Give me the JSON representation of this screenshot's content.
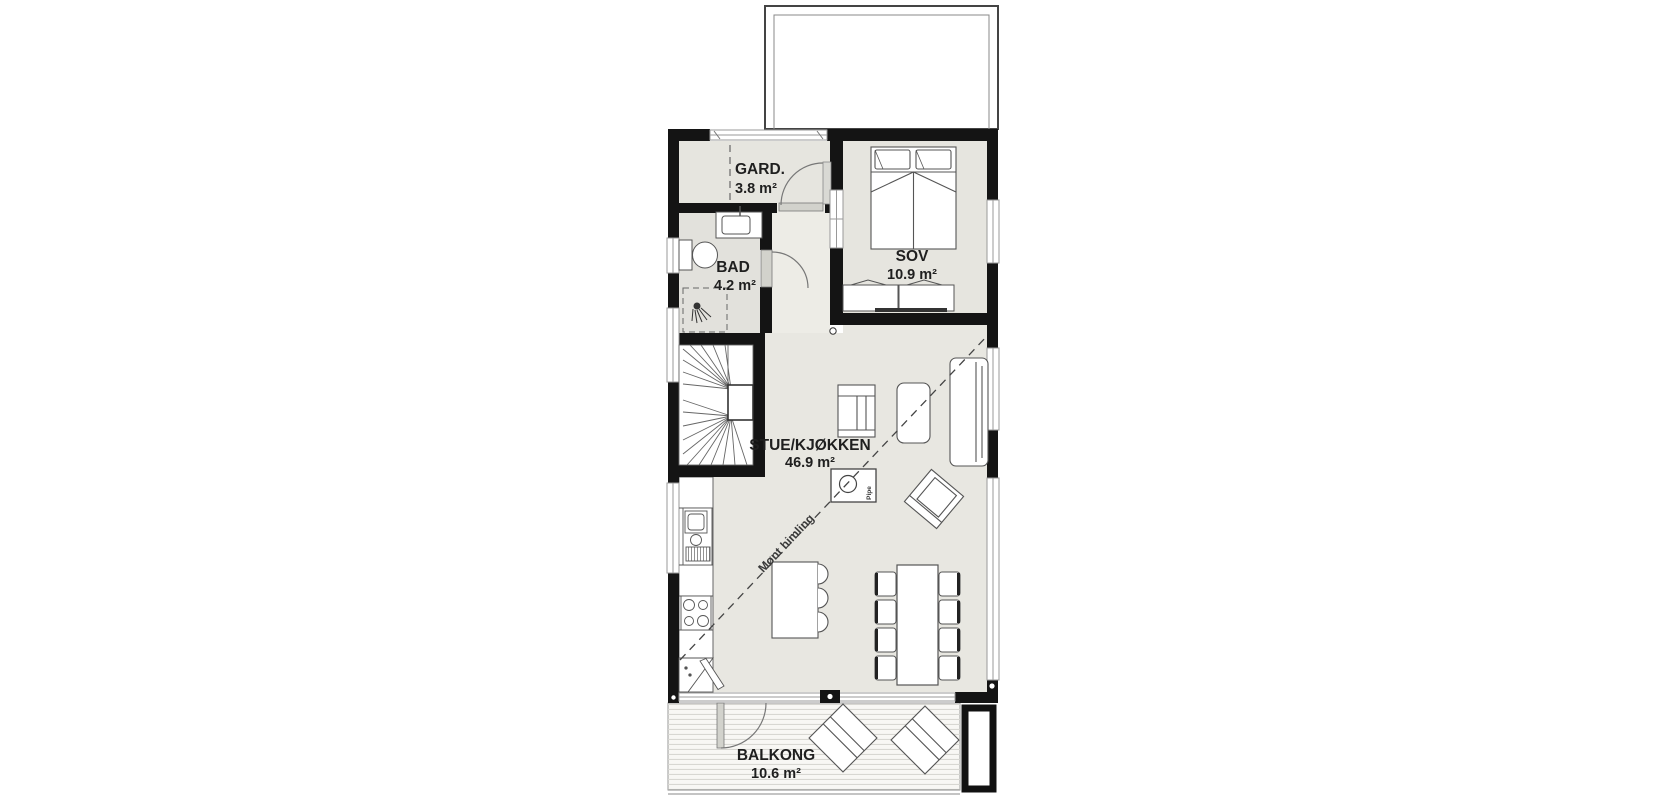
{
  "plan": {
    "rooms": [
      {
        "id": "gard",
        "label": "GARD.",
        "area": "3.8 m²"
      },
      {
        "id": "bad",
        "label": "BAD",
        "area": "4.2 m²"
      },
      {
        "id": "sov",
        "label": "SOV",
        "area": "10.9 m²"
      },
      {
        "id": "stue",
        "label": "STUE/KJØKKEN",
        "area": "46.9 m²"
      },
      {
        "id": "balkong",
        "label": "BALKONG",
        "area": "10.6 m²"
      }
    ],
    "annotations": {
      "ridge_line": {
        "label": "Mønt himling"
      },
      "chimney": {
        "label": "Pipe"
      }
    },
    "palette": {
      "wall": "#141414",
      "room_fill": "#e6e5df",
      "bath_fill": "#e2e1dc",
      "light_floor": "#fbfaf6",
      "window_frame": "#9a9a9a",
      "furniture_stroke": "#555555",
      "deck_line": "#d8d7d2",
      "door_leaf": "#d2d2cc"
    }
  }
}
